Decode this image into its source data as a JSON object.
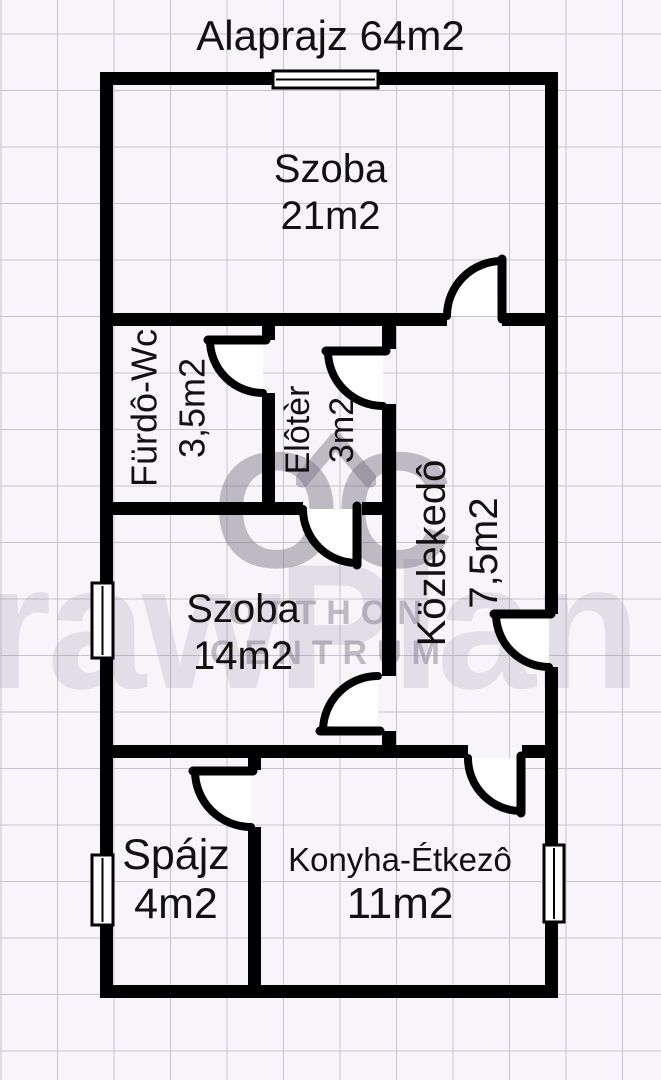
{
  "title": "Alaprajz 64m2",
  "total_area": "64m2",
  "rooms": [
    {
      "name": "Szoba",
      "area": "21m2",
      "orientation": "horizontal"
    },
    {
      "name": "Fürdô-Wc",
      "area": "3,5m2",
      "orientation": "vertical"
    },
    {
      "name": "Elôtèr",
      "area": "3m2",
      "orientation": "vertical"
    },
    {
      "name": "Közlekedô",
      "area": "7,5m2",
      "orientation": "vertical"
    },
    {
      "name": "Szoba",
      "area": "14m2",
      "orientation": "horizontal"
    },
    {
      "name": "Spájz",
      "area": "4m2",
      "orientation": "horizontal"
    },
    {
      "name": "Konyha-Étkezô",
      "area": "11m2",
      "orientation": "horizontal"
    }
  ],
  "watermark": {
    "background_text": "rawPlan",
    "logo_text": "OC",
    "logo_line1": "OTTHON",
    "logo_line2": "CENTRUM"
  },
  "plan": {
    "doors": 8,
    "windows": 4
  },
  "colors": {
    "bg": "#f8f5fa",
    "grid-line": "#c6c2ce",
    "wall": "#000000",
    "text": "#111111",
    "wm-light": "rgba(138,130,160,0.20)",
    "wm-logo": "rgba(110,104,122,0.42)",
    "door-fill": "#ffffff"
  }
}
